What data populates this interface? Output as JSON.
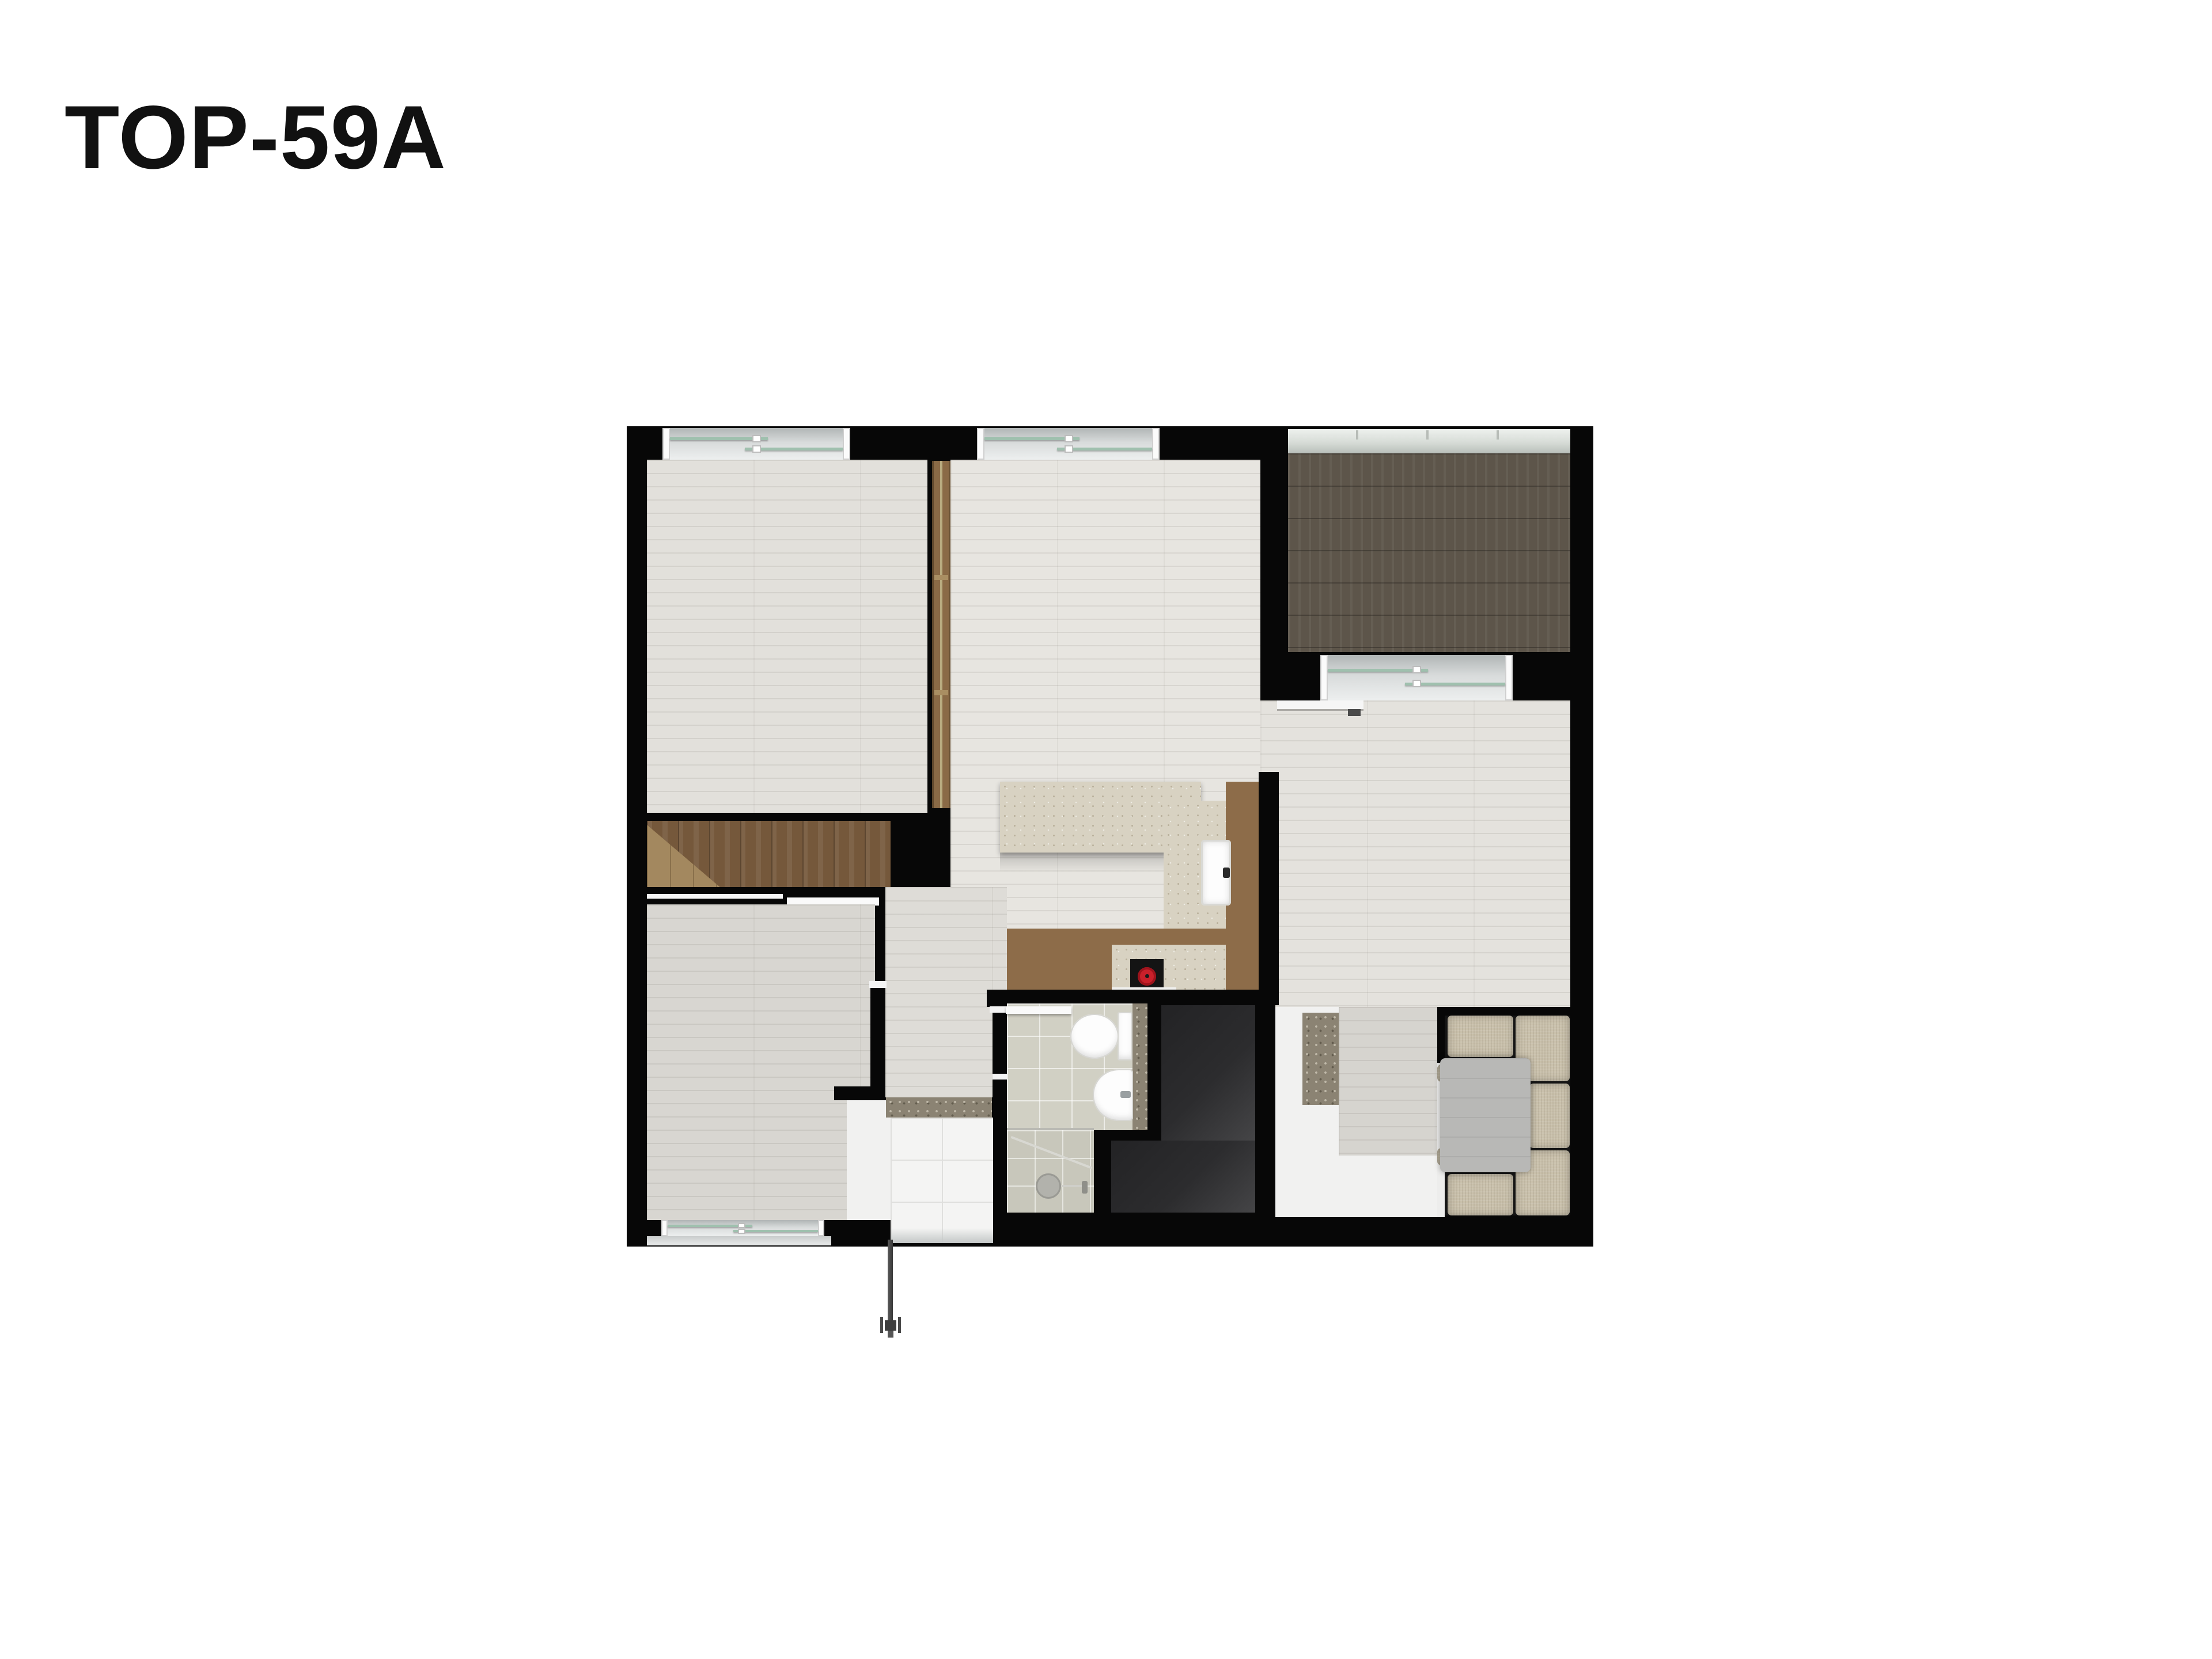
{
  "page": {
    "background": "#ffffff"
  },
  "header": {
    "title": "TOP-59A"
  },
  "floorplan": {
    "kind": "apartment-unit-top-down-render",
    "unit_code": "TOP-59A",
    "palette": {
      "wall": "#070707",
      "bedroom_floor": "#e2e0db",
      "living_floor": "#e7e5e0",
      "lower_floor": "#d8d6d1",
      "balcony_floor": "#5d554a",
      "stairs_wood": "#75583b",
      "stairs_light_wood": "#a3885f",
      "counter_brown": "#8d6c49",
      "counter_stone": "#d8d2c2",
      "entry_stone_mat": "#8b8373",
      "bathroom_tile": "#d1d0c4",
      "shower_tile": "#c8c7bb",
      "entry_tile": "#f4f4f3",
      "utility_charcoal": "#2c2c2e",
      "sofa_cushion": "#c9c0ab",
      "sofa_table": "#b8b8b6",
      "window_glass": "#9fc0ae",
      "window_frame": "#fbfbfb",
      "cooktop_burner_red": "#c8202a",
      "sliding_partition_brown": "#8a6a46"
    }
  }
}
